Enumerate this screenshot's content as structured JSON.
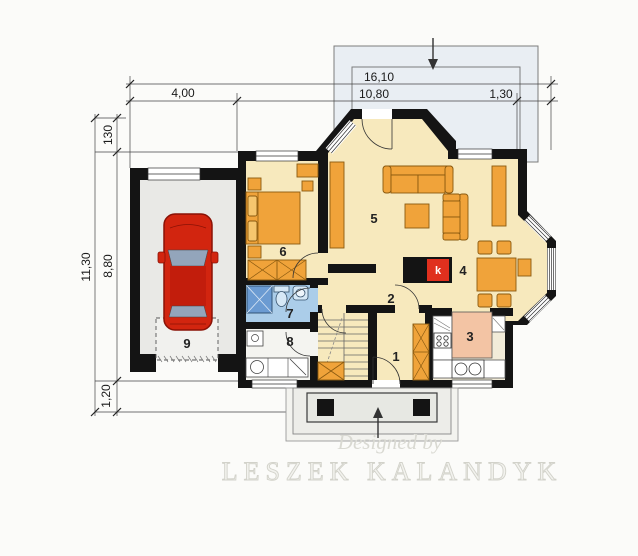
{
  "dimensions": {
    "top_total": "16,10",
    "top_left": "4,00",
    "top_mid": "10,80",
    "top_right": "1,30",
    "left_total": "11,30",
    "left_top": "130",
    "left_mid": "8,80",
    "left_bottom": "1,20"
  },
  "rooms": [
    {
      "number": "1"
    },
    {
      "number": "2"
    },
    {
      "number": "3"
    },
    {
      "number": "4"
    },
    {
      "number": "5"
    },
    {
      "number": "6"
    },
    {
      "number": "7"
    },
    {
      "number": "8"
    },
    {
      "number": "9"
    }
  ],
  "fireplace": {
    "label": "k"
  },
  "watermark": {
    "line1": "Designed by",
    "line2": "LESZEK KALANDYK"
  },
  "colors": {
    "wall": "#141414",
    "floor": "#f7e9bd",
    "furniture": "#f0a33a",
    "bathroom_floor": "#abcde9",
    "shower": "#6b9bd2",
    "kitchen_island": "#f3c4a4",
    "garage_floor": "#e9e9e6",
    "terrace": "#e9eef3",
    "car": "#d2250f",
    "fireplace_red": "#e0301e"
  }
}
